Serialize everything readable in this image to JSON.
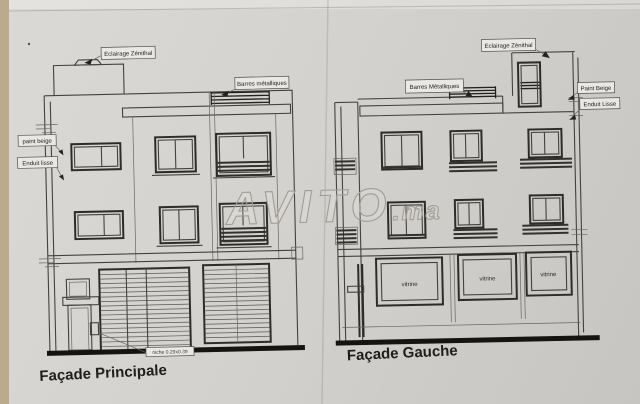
{
  "facade_principale": {
    "title": "Façade Principale",
    "labels": {
      "eclairage_zenithal": "Eclairage Zénithal",
      "barres_metalliques": "Barres métalliques",
      "paint_beige": "paint beige",
      "enduit_lisse": "Enduit lisse",
      "niche": "niche 0.29x0.39"
    }
  },
  "facade_gauche": {
    "title": "Façade Gauche",
    "labels": {
      "eclairage_zenithal": "Eclairage Zénithal",
      "barres_metalliques": "Barres Métalliques",
      "paint_beige": "Paint Beige",
      "enduit_lisse": "Enduit Lisse"
    },
    "vitrines": [
      "vitrine",
      "vitrine",
      "vitrine"
    ]
  },
  "watermark": {
    "brand": "AVITO",
    "suffix": ".ma"
  },
  "colors": {
    "paper": "#d5d3cf",
    "line": "#45423e",
    "dark_ground": "#161412",
    "edge_strip": "#bcaa8f",
    "watermark": "#a29d95"
  }
}
